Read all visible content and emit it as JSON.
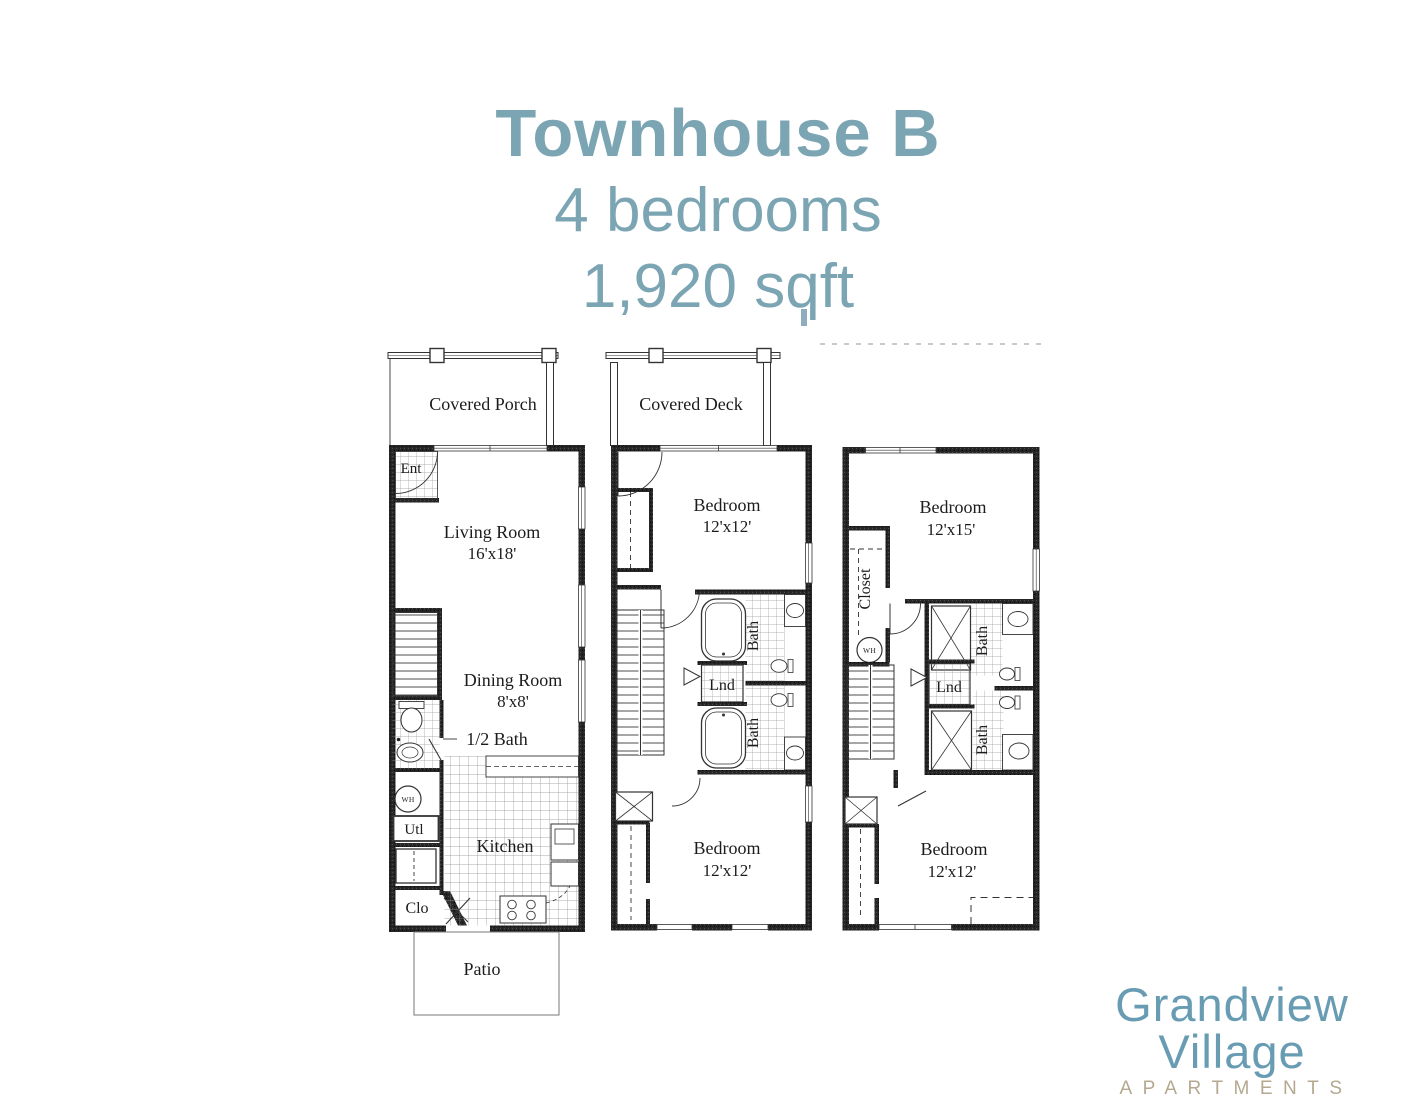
{
  "header": {
    "title": "Townhouse B",
    "bedrooms": "4 bedrooms",
    "area": "1,920 sqft"
  },
  "colors": {
    "title_blue": "#7ca5b4",
    "logo_blue": "#689cb3",
    "logo_tan": "#b4a990",
    "plan_ink": "#1c1c1c"
  },
  "floor1": {
    "porch": "Covered Porch",
    "ent": "Ent",
    "living_room": "Living Room",
    "living_room_dims": "16'x18'",
    "dining_room": "Dining Room",
    "dining_room_dims": "8'x8'",
    "half_bath": "1/2 Bath",
    "water_heater": "WH",
    "utility": "Utl",
    "kitchen": "Kitchen",
    "closet": "Clo",
    "patio": "Patio"
  },
  "floor2": {
    "deck": "Covered Deck",
    "bedroom_upper": "Bedroom",
    "bedroom_upper_dims": "12'x12'",
    "bath_upper": "Bath",
    "laundry": "Lnd",
    "bath_lower": "Bath",
    "bedroom_lower": "Bedroom",
    "bedroom_lower_dims": "12'x12'"
  },
  "floor3": {
    "bedroom_upper": "Bedroom",
    "bedroom_upper_dims": "12'x15'",
    "closet": "Closet",
    "water_heater": "WH",
    "bath_upper": "Bath",
    "laundry": "Lnd",
    "bath_lower": "Bath",
    "bedroom_lower": "Bedroom",
    "bedroom_lower_dims": "12'x12'"
  },
  "logo": {
    "name": "Grandview Village",
    "subtitle": "APARTMENTS"
  }
}
